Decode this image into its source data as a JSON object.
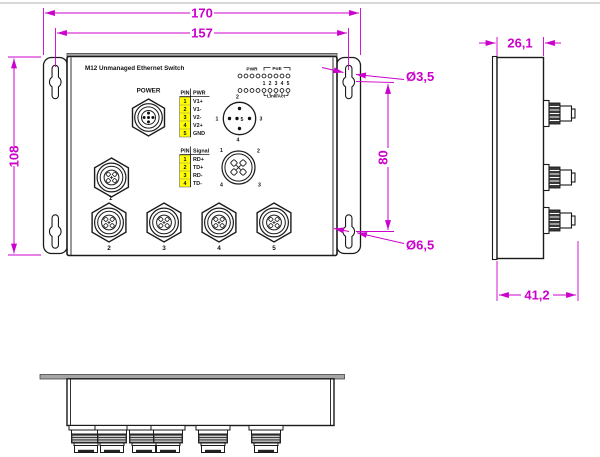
{
  "device": {
    "title": "M12 Unmanaged Ethernet Switch",
    "power_label": "POWER"
  },
  "dims": {
    "total_width": "170",
    "hole_spacing": "157",
    "total_height": "108",
    "hole_vertical_spacing": "80",
    "slot_diameter": "Ø3,5",
    "hole_diameter": "Ø6,5",
    "body_depth": "26,1",
    "total_depth": "41,2"
  },
  "leds": {
    "pwr_label": "PWR",
    "poe_label": "PoE",
    "linkact_label": "Link/Act",
    "port_numbers": [
      "1",
      "2",
      "3",
      "4",
      "5"
    ]
  },
  "pwr_table": {
    "col_pin": "PIN",
    "col_val": "PWR",
    "rows": [
      {
        "pin": "1",
        "val": "V1+"
      },
      {
        "pin": "2",
        "val": "V1-"
      },
      {
        "pin": "3",
        "val": "V2-"
      },
      {
        "pin": "4",
        "val": "V2+"
      },
      {
        "pin": "5",
        "val": "GND"
      }
    ]
  },
  "signal_table": {
    "col_pin": "PIN",
    "col_val": "Signal",
    "rows": [
      {
        "pin": "1",
        "val": "RD+"
      },
      {
        "pin": "2",
        "val": "TD+"
      },
      {
        "pin": "3",
        "val": "RD-"
      },
      {
        "pin": "4",
        "val": "TD-"
      }
    ]
  },
  "power_pinout": {
    "p1": "1",
    "p2": "2",
    "p3": "3",
    "p4": "4",
    "p5": "5"
  },
  "data_pinout": {
    "p1": "1",
    "p2": "2",
    "p3": "3",
    "p4": "4"
  },
  "ports": {
    "p1": "1",
    "p2": "2",
    "p3": "3",
    "p4": "4",
    "p5": "5"
  },
  "colors": {
    "dimension": "#CC00CC",
    "highlight": "#FFFF00",
    "line": "#1A1A1A",
    "plate_gray": "#A6A6A6"
  }
}
